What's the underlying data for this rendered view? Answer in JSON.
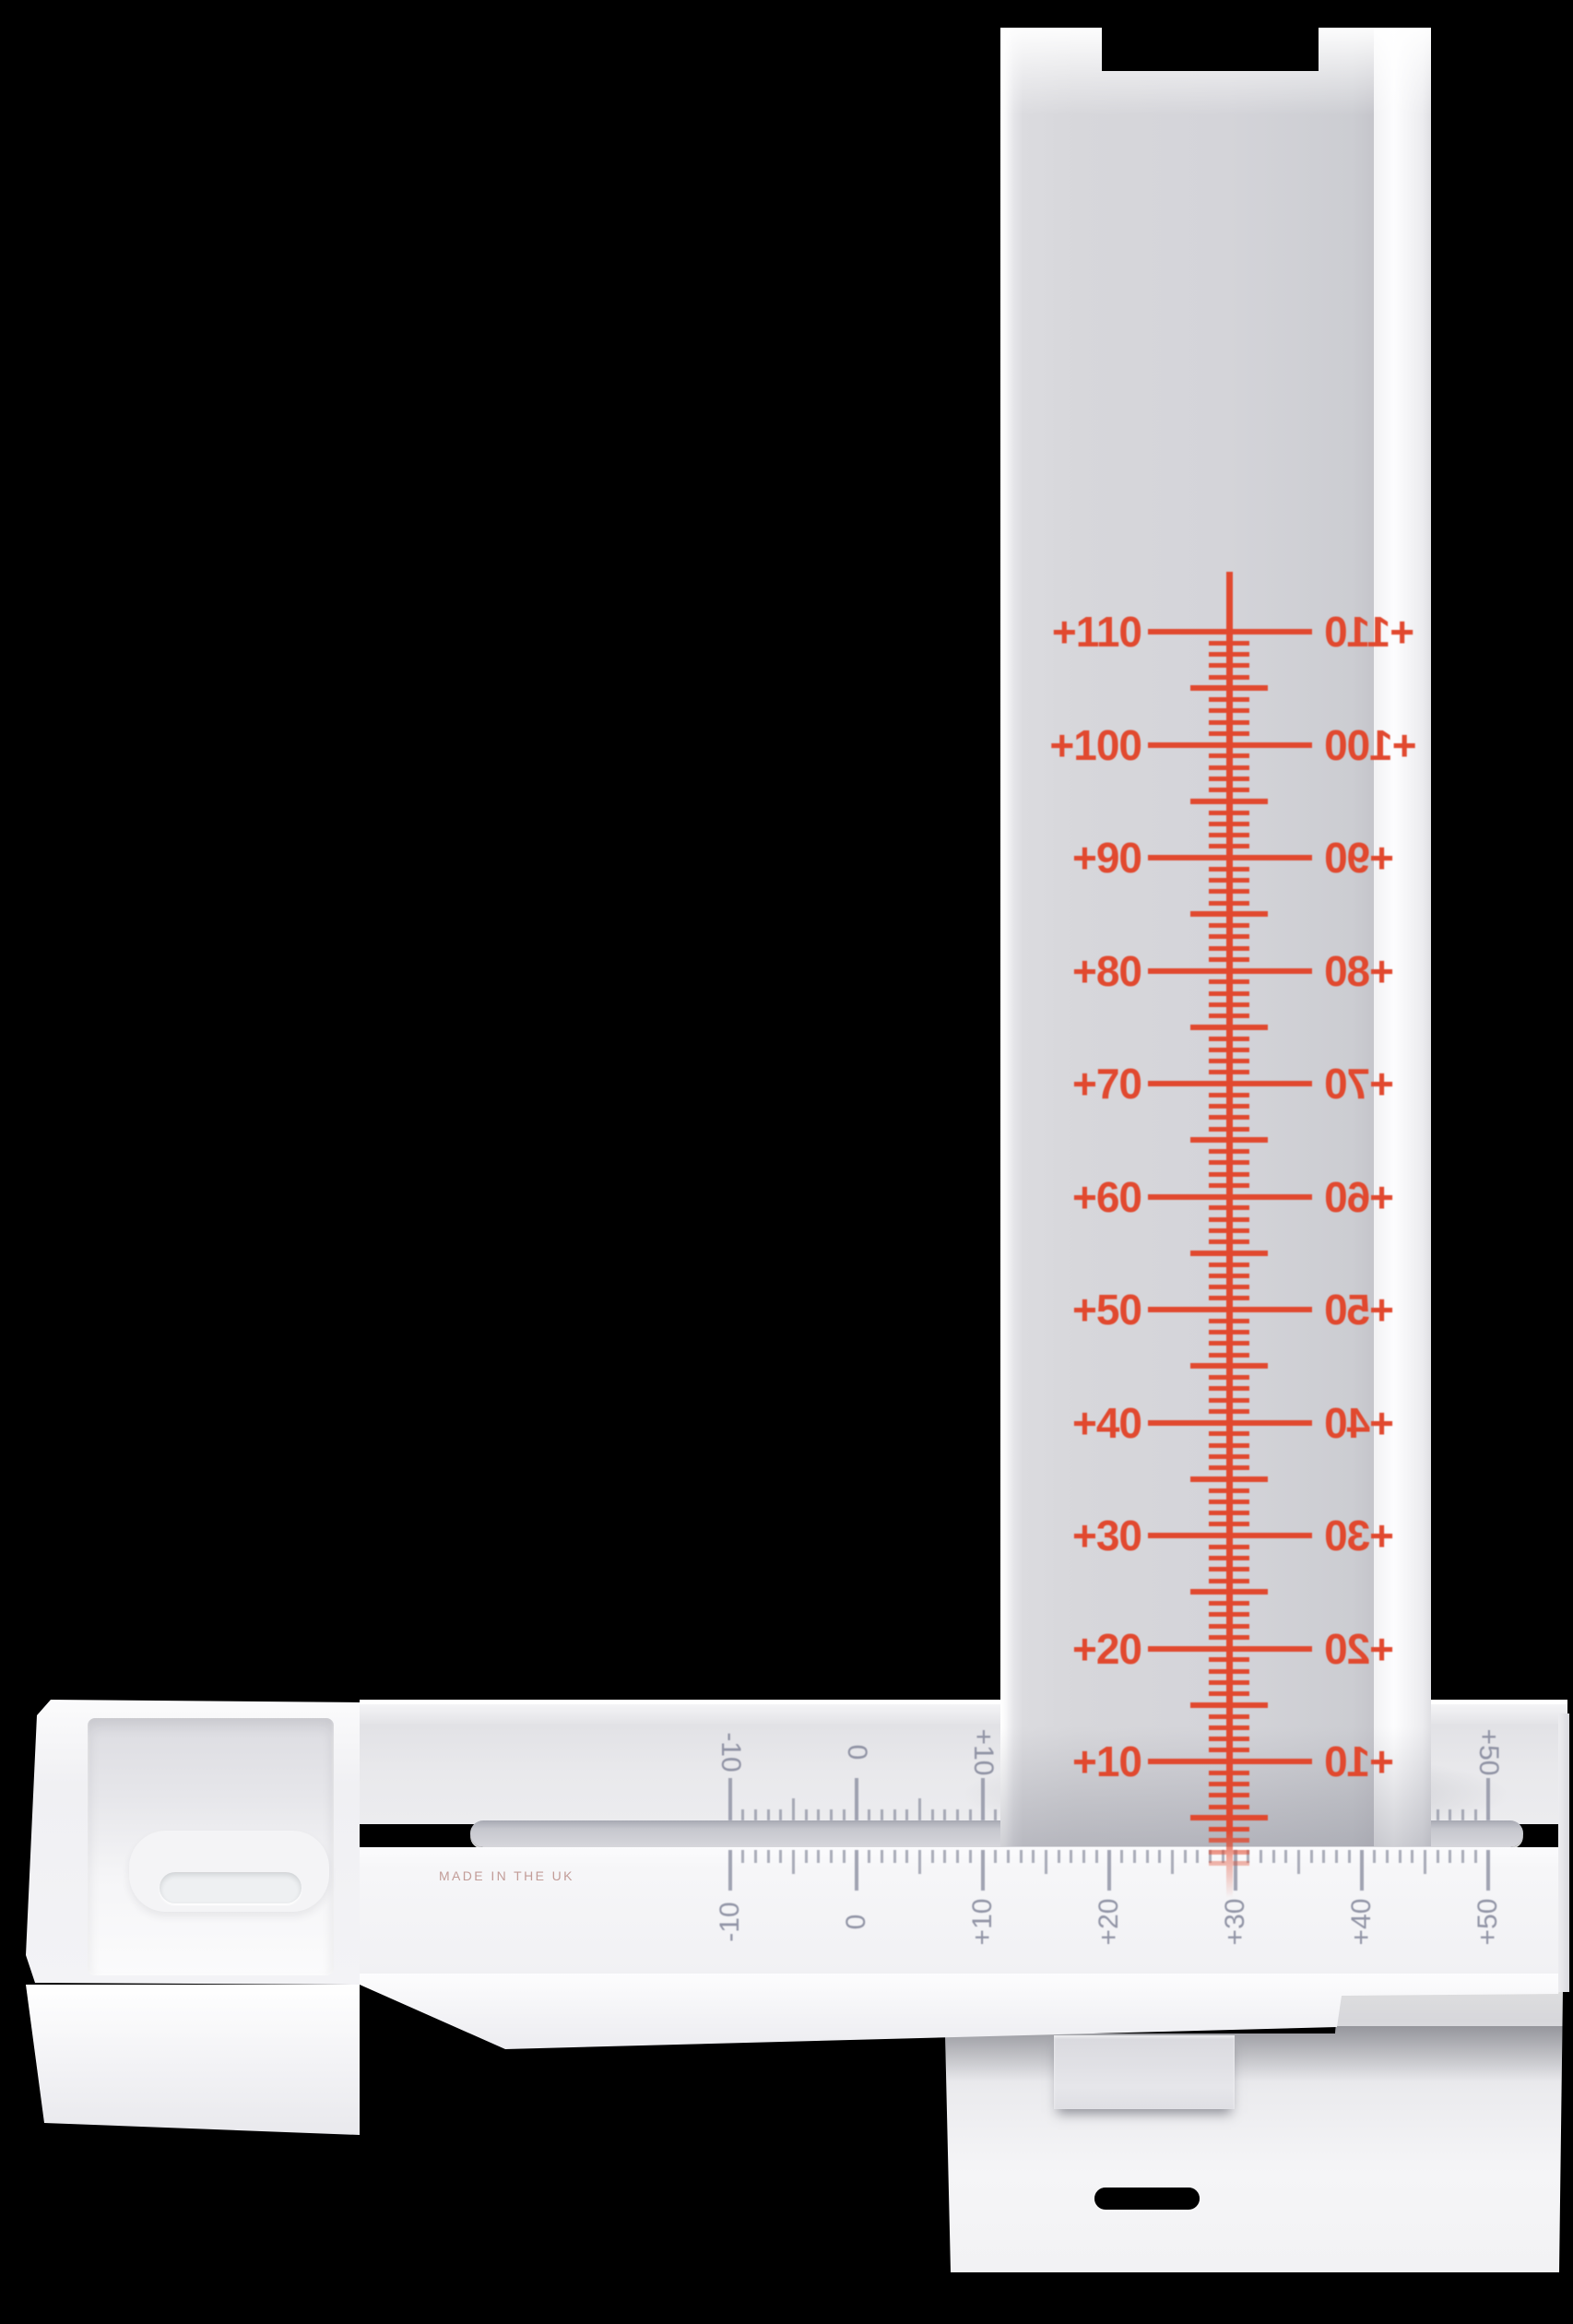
{
  "device": {
    "type": "white plastic measuring gauge with vertical scale on a slotted base",
    "made_in_label": "MADE IN THE UK"
  },
  "palette": {
    "background": "#000000",
    "plastic_white": "#f2f2f4",
    "plastic_shadow": "#d6d6da",
    "scale_red": "#e1492f",
    "ruler_gray": "#8b8fa0"
  },
  "column_scale": {
    "ink_color": "#e1492f",
    "orientation": "vertical",
    "major_labels": [
      "+110",
      "+100",
      "+90",
      "+80",
      "+70",
      "+60",
      "+50",
      "+40",
      "+30",
      "+20",
      "+10"
    ],
    "major_values": [
      110,
      100,
      90,
      80,
      70,
      60,
      50,
      40,
      30,
      20,
      10
    ],
    "minor_step": 1,
    "medium_step": 5,
    "right_labels_mirrored": true,
    "pointer_line": true
  },
  "base_rulers": {
    "ink_color": "#8b8fa0",
    "labels": [
      "-10",
      "0",
      "+10",
      "+20",
      "+30",
      "+40",
      "+50"
    ],
    "label_values": [
      -10,
      0,
      10,
      20,
      30,
      40,
      50
    ],
    "min": -10,
    "max": 50,
    "minor_step": 1,
    "medium_step": 5,
    "major_step": 10,
    "rows": [
      {
        "name": "back",
        "label_rotation_deg": 90
      },
      {
        "name": "front",
        "label_rotation_deg": -90
      }
    ]
  }
}
